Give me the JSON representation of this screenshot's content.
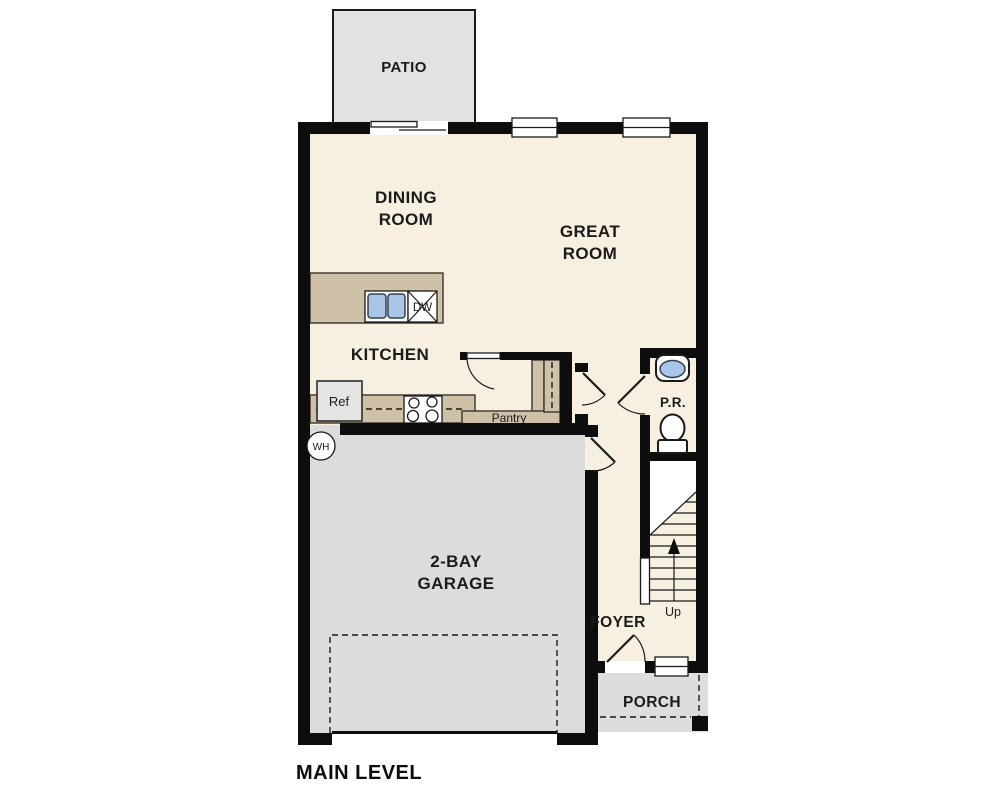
{
  "title": "MAIN LEVEL",
  "labels": {
    "patio": "PATIO",
    "dining_line1": "DINING",
    "dining_line2": "ROOM",
    "great_line1": "GREAT",
    "great_line2": "ROOM",
    "kitchen": "KITCHEN",
    "garage_line1": "2-BAY",
    "garage_line2": "GARAGE",
    "foyer": "FOYER",
    "porch": "PORCH",
    "powder_room": "P.R.",
    "pantry": "Pantry",
    "stairs_up": "Up",
    "refrigerator": "Ref",
    "dishwasher": "DW",
    "water_heater": "WH"
  },
  "colors": {
    "wall": "#0d0d0d",
    "floor": "#f7efe0",
    "garage": "#dcdcda",
    "patio": "#e3e2e0",
    "porch": "#dedddb",
    "counter": "#cfc1a8",
    "sink": "#a9c6e8"
  }
}
